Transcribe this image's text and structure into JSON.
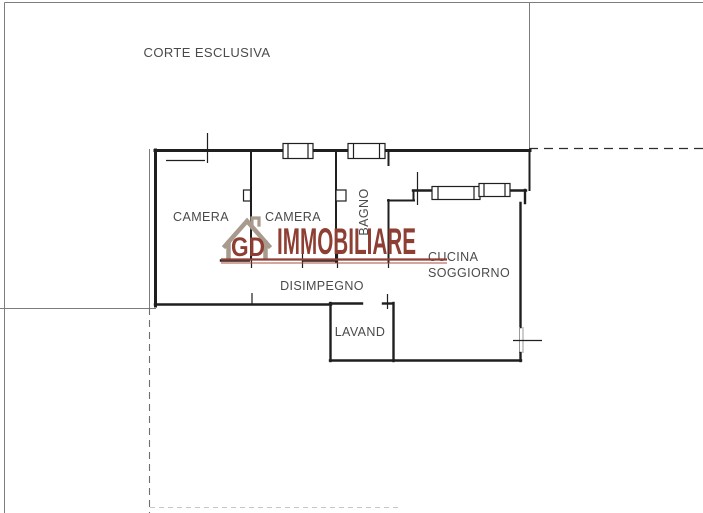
{
  "plan": {
    "background": "#ffffff",
    "wall_color": "#1f1f1f",
    "boundary_color": "#7d7d7d",
    "label_color": "#4a4a4a",
    "labels": {
      "court": "CORTE ESCLUSIVA",
      "bedroom1": "CAMERA",
      "bedroom2": "CAMERA",
      "bathroom": "BAGNO",
      "kitchen_line1": "CUCINA",
      "kitchen_line2": "SOGGIORNO",
      "hallway": "DISIMPEGNO",
      "laundry": "LAVAND"
    }
  },
  "watermark": {
    "monogram": "GD",
    "brand": "IMMOBILIARE",
    "brand_color": "#8f3e33",
    "underline_color": "#a05243",
    "house_icon_color": "#a89a8c"
  }
}
